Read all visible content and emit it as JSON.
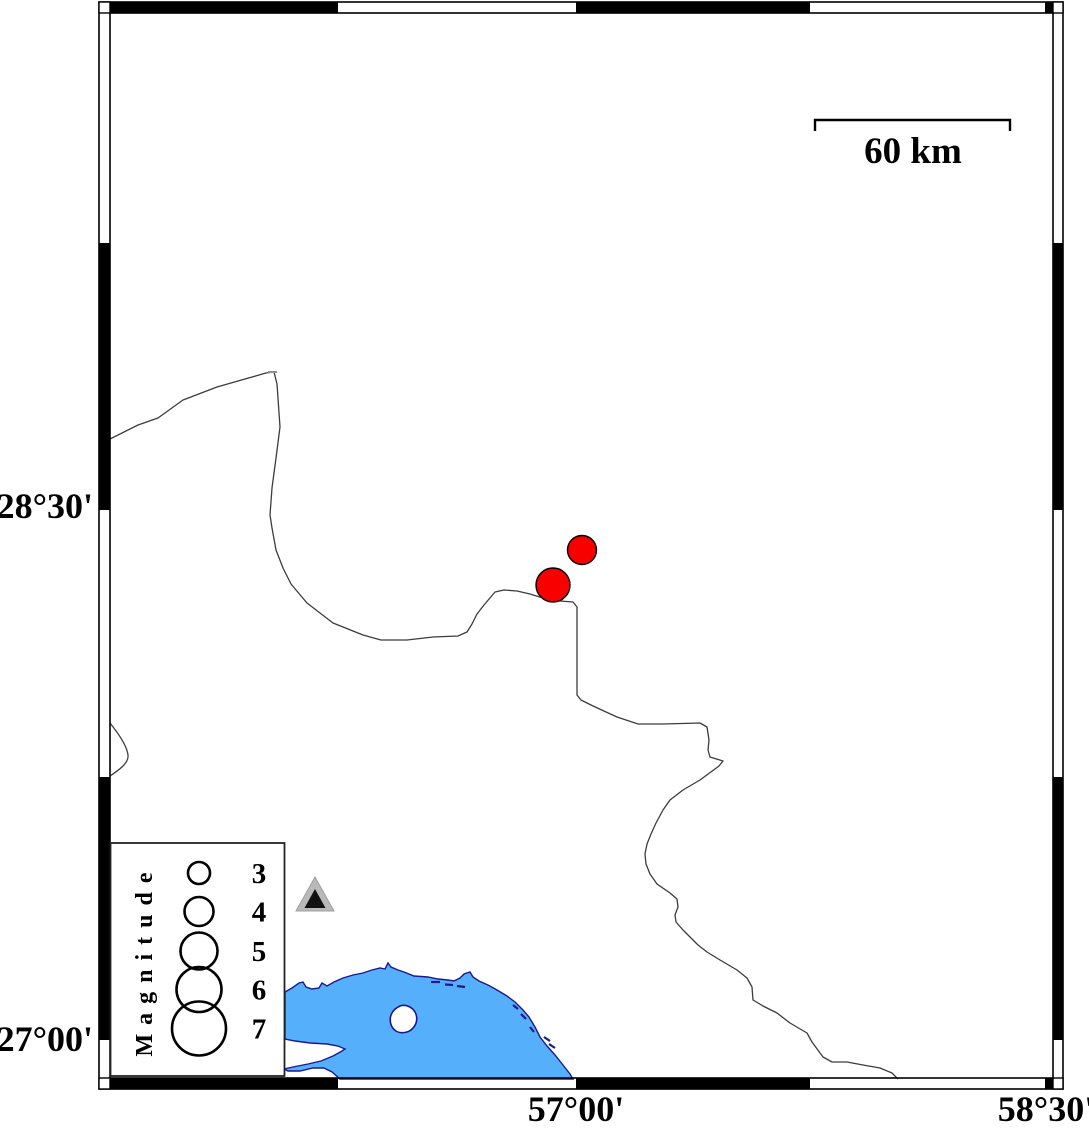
{
  "figure": {
    "type": "seismicity-map",
    "margin_labels": {
      "lat": [
        "28°30'",
        "27°00'"
      ],
      "lon": [
        "57°00'",
        "58°30'"
      ]
    },
    "scale_bar": {
      "label": "60 km",
      "length_px": 195
    },
    "legend": {
      "title": "Magnitude",
      "entries": [
        {
          "label": "3",
          "radius_px": 11
        },
        {
          "label": "4",
          "radius_px": 14.5
        },
        {
          "label": "5",
          "radius_px": 18.5
        },
        {
          "label": "6",
          "radius_px": 22.5
        },
        {
          "label": "7",
          "radius_px": 27
        }
      ]
    },
    "earthquakes": [
      {
        "x_px": 553,
        "y_px": 585,
        "radius_px": 17,
        "magnitude_est": 4.5,
        "lon_est": "56°56'E",
        "lat_est": "28°17'N"
      },
      {
        "x_px": 582,
        "y_px": 550,
        "radius_px": 14.5,
        "magnitude_est": 4.0,
        "lon_est": "57°01'E",
        "lat_est": "28°23'N"
      }
    ],
    "station_marker": {
      "x_px": 315,
      "y_px": 897,
      "shape": "triangle"
    },
    "colors": {
      "earthquake_fill": "#f80000",
      "water_fill": "#56affb",
      "coastline": "#1a1a90",
      "boundary_line": "#3c3c3c",
      "frame": "#000000",
      "station_outer": "#b9b9b9",
      "station_inner": "#111111",
      "background": "#ffffff"
    }
  }
}
